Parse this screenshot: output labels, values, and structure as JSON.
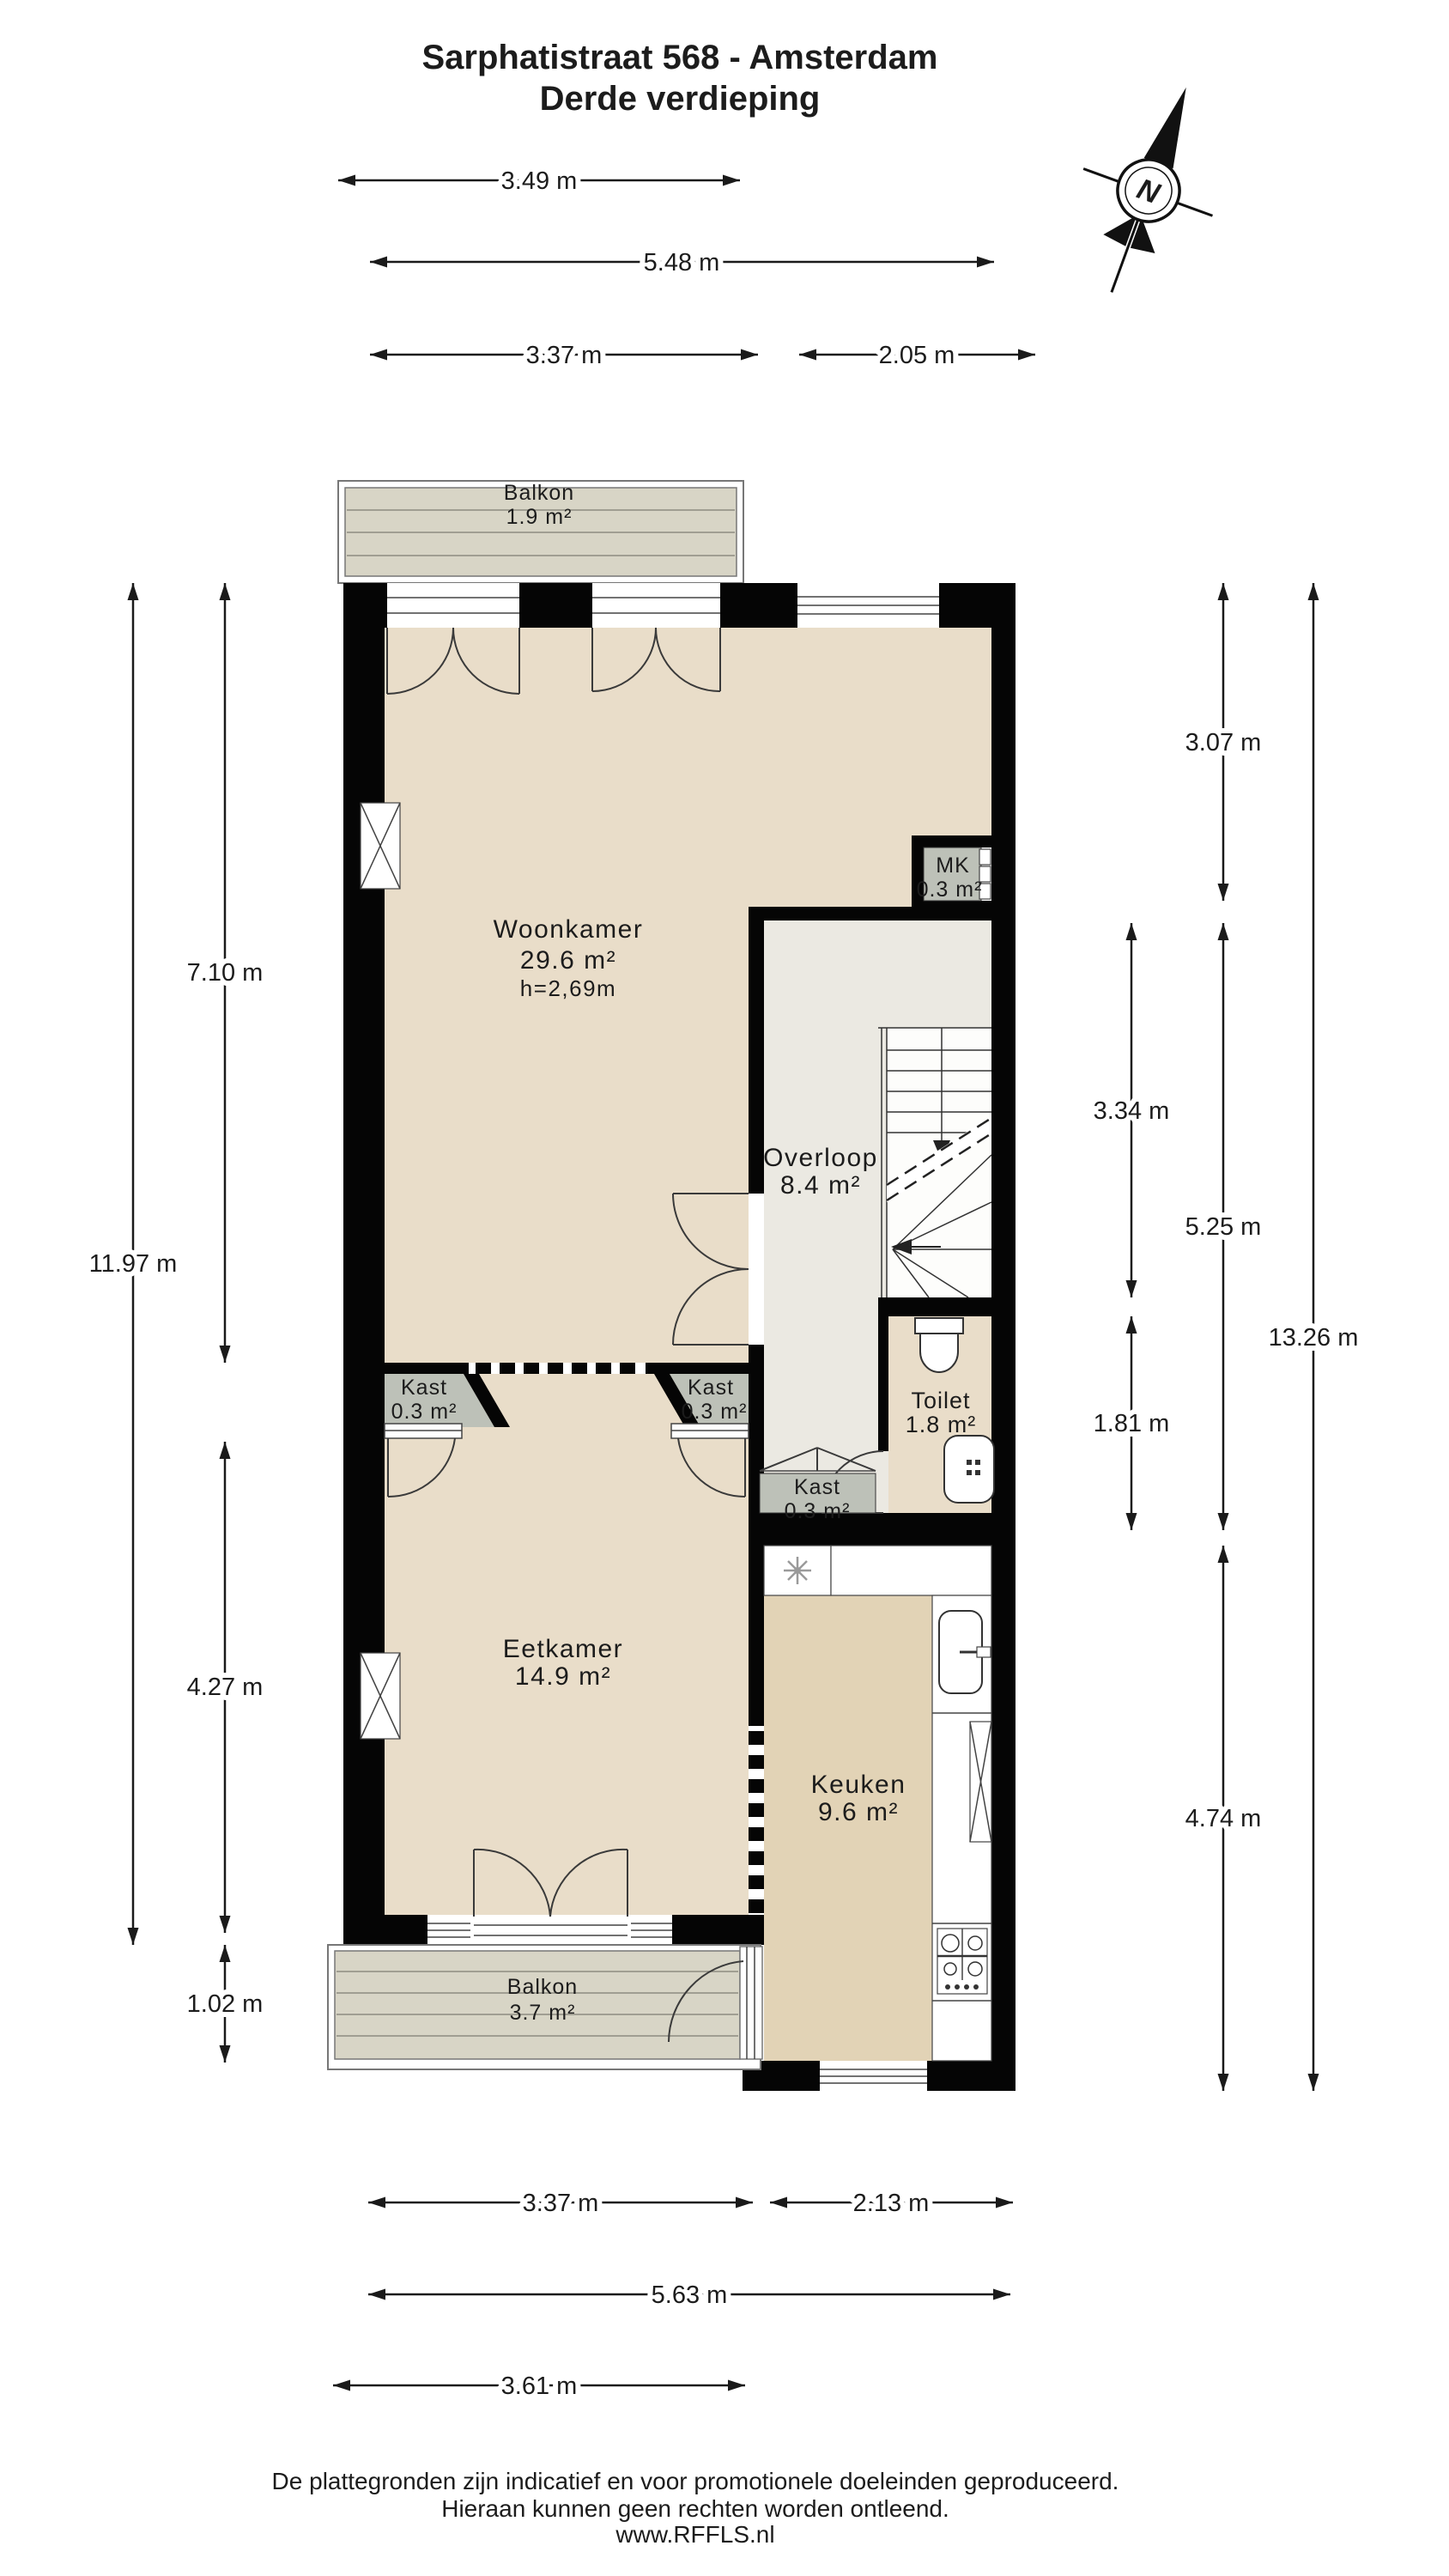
{
  "title": {
    "line1": "Sarphatistraat 568 - Amsterdam",
    "line2": "Derde verdieping"
  },
  "compass": {
    "label": "N"
  },
  "rooms": {
    "balkon_top": {
      "name": "Balkon",
      "area": "1.9 m²"
    },
    "woonkamer": {
      "name": "Woonkamer",
      "area": "29.6 m²",
      "height": "h=2,69m"
    },
    "mk": {
      "name": "MK",
      "area": "0.3 m²"
    },
    "overloop": {
      "name": "Overloop",
      "area": "8.4 m²"
    },
    "toilet": {
      "name": "Toilet",
      "area": "1.8 m²"
    },
    "kast_links": {
      "name": "Kast",
      "area": "0.3 m²"
    },
    "kast_rechts": {
      "name": "Kast",
      "area": "0.3 m²"
    },
    "kast_trap": {
      "name": "Kast",
      "area": "0.3 m²"
    },
    "eetkamer": {
      "name": "Eetkamer",
      "area": "14.9 m²"
    },
    "keuken": {
      "name": "Keuken",
      "area": "9.6 m²"
    },
    "balkon_onder": {
      "name": "Balkon",
      "area": "3.7 m²"
    }
  },
  "dimensions": {
    "top": [
      {
        "label": "3.49 m"
      },
      {
        "label": "5.48 m"
      },
      {
        "label": "3.37 m"
      },
      {
        "label": "2.05 m"
      }
    ],
    "bottom": [
      {
        "label": "3.37 m"
      },
      {
        "label": "2.13 m"
      },
      {
        "label": "5.63 m"
      },
      {
        "label": "3.61 m"
      }
    ],
    "left": [
      {
        "label": "7.10 m"
      },
      {
        "label": "11.97 m"
      },
      {
        "label": "4.27 m"
      },
      {
        "label": "1.02 m"
      }
    ],
    "right": [
      {
        "label": "3.07 m"
      },
      {
        "label": "3.34 m"
      },
      {
        "label": "5.25 m"
      },
      {
        "label": "1.81 m"
      },
      {
        "label": "13.26 m"
      },
      {
        "label": "4.74 m"
      }
    ]
  },
  "footer": {
    "line1": "De plattegronden zijn indicatief en voor promotionele doeleinden geproduceerd.",
    "line2": "Hieraan kunnen geen rechten worden ontleend.",
    "line3": "www.RFFLS.nl"
  },
  "colors": {
    "wall": "#050505",
    "floor": "#e9ddc9",
    "floor-keuken": "#e2d3b6",
    "floor-overloop": "#ebe9e2",
    "balcony": "#d8d5c6",
    "closet": "#bdc1b8",
    "line": "#1a1a1a"
  }
}
